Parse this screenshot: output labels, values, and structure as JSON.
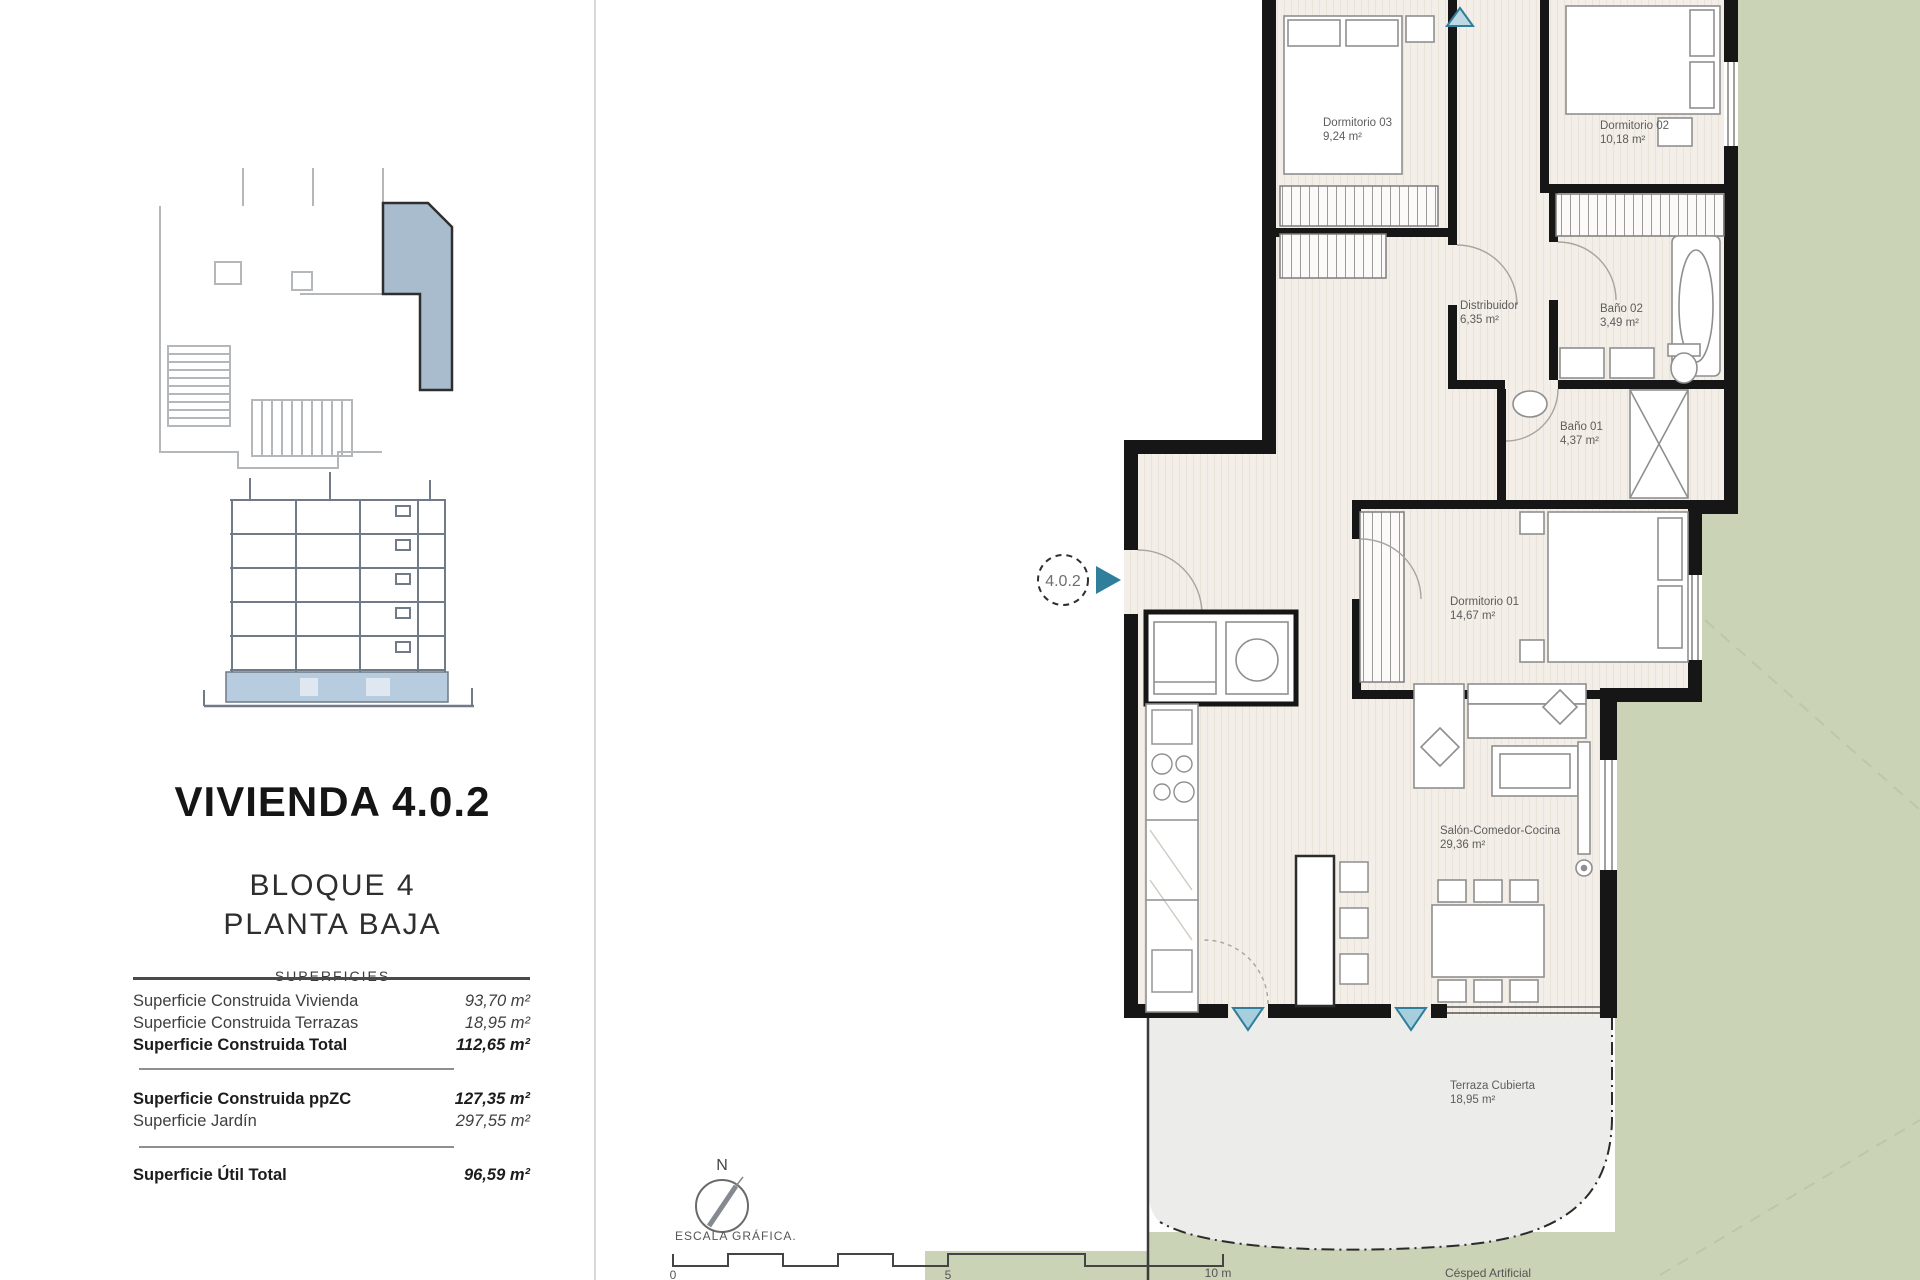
{
  "panel": {
    "title": "VIVIENDA 4.0.2",
    "block_line1": "BLOQUE 4",
    "block_line2": "PLANTA BAJA",
    "surfaces_header": "SUPERFICIES",
    "rows": [
      {
        "label": "Superficie Construida Vivienda",
        "value": "93,70 m²"
      },
      {
        "label": "Superficie Construida Terrazas",
        "value": "18,95 m²"
      },
      {
        "label": "Superficie Construida Total",
        "value": "112,65 m²"
      },
      {
        "label": "Superficie Construida ppZC",
        "value": "127,35 m²"
      },
      {
        "label": "Superficie Jardín",
        "value": "297,55 m²"
      },
      {
        "label": "Superficie Útil Total",
        "value": "96,59 m²"
      }
    ]
  },
  "plan": {
    "unit_marker": "4.0.2",
    "rooms": [
      {
        "name": "Dormitorio 03",
        "area": "9,24 m²"
      },
      {
        "name": "Dormitorio 02",
        "area": "10,18 m²"
      },
      {
        "name": "Distribuidor",
        "area": "6,35 m²"
      },
      {
        "name": "Baño 02",
        "area": "3,49 m²"
      },
      {
        "name": "Baño 01",
        "area": "4,37 m²"
      },
      {
        "name": "Dormitorio 01",
        "area": "14,67 m²"
      },
      {
        "name": "Salón-Comedor-Cocina",
        "area": "29,36 m²"
      },
      {
        "name": "Terraza Cubierta",
        "area": "18,95 m²"
      }
    ],
    "garden_label": "Césped Artificial",
    "compass_label": "N",
    "scale_label": "ESCALA GRÁFICA.",
    "scale_ticks": [
      "0",
      "5",
      "10 m"
    ]
  },
  "colors": {
    "garden_green": "#cbd3b6",
    "accent_teal": "#2f7e9b",
    "key_highlight_blue": "#a9bccd",
    "section_plinth_blue": "#b8cce0",
    "wall_black": "#161616"
  }
}
